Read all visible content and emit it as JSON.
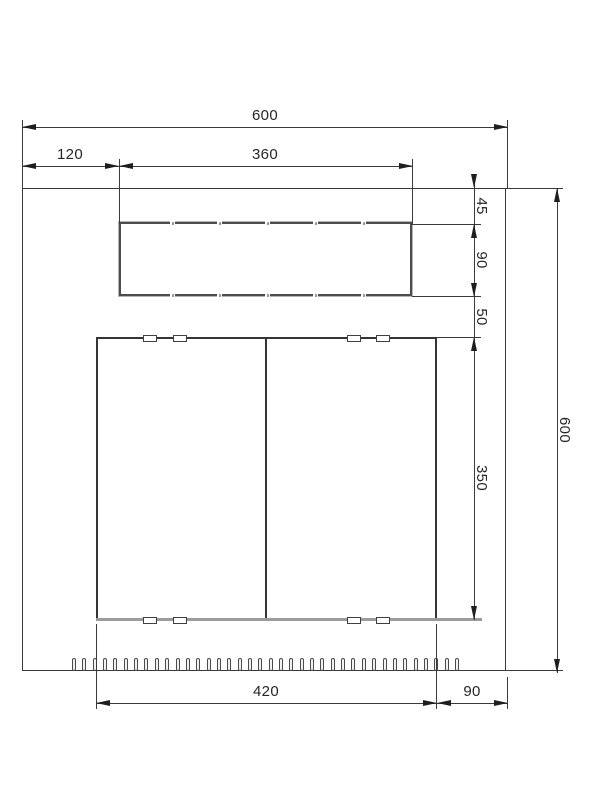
{
  "dims": {
    "overall_width": "600",
    "offset_left": "120",
    "slot_width": "360",
    "top_margin": "45",
    "slot_height": "90",
    "slot_door_gap": "50",
    "door_height": "350",
    "door_width": "420",
    "right_margin": "90",
    "overall_height": "600"
  },
  "colors": {
    "line": "#3a3a3a",
    "object_edge": "#353535",
    "sill_gray": "#9c9c9c",
    "background": "#ffffff"
  },
  "features": {
    "vent_count": 38,
    "hinge_clip_count": 8,
    "door_leaf_count": 2,
    "slot_tick_count": 10
  }
}
